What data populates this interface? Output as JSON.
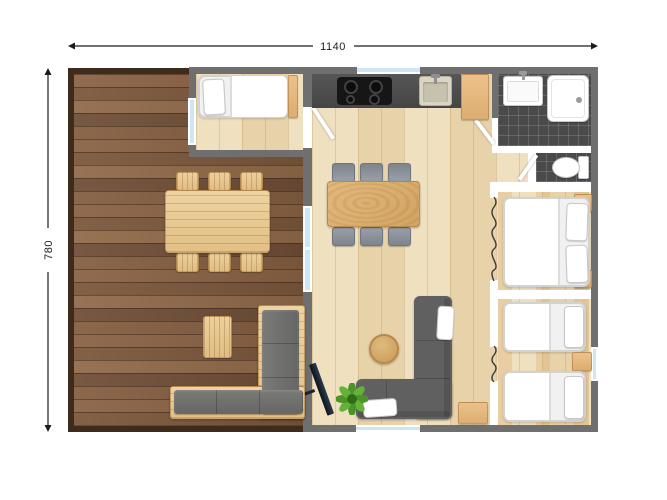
{
  "plan": {
    "width_label": "1140",
    "height_label": "780"
  },
  "colors": {
    "wall": "#6f6f6f",
    "partition": "#ffffff",
    "deck_frame": "#3e2b1c",
    "deck_wood": "#82593c",
    "floor_wood": "#ecdab4",
    "tile": "#4a4a4a",
    "counter": "#4b4b4b",
    "cooktop": "#161616",
    "wood_furniture": "#e3b77f",
    "outdoor_wood": "#e9c992",
    "sofa_gray": "#606060",
    "chair_gray": "#8f959e",
    "cushion_gray": "#6f6f6d",
    "bed_white": "#f1f1f1",
    "window_glass": "#cde6f5",
    "plant_green": "#55a62f",
    "tv_dark": "#16222e",
    "dim_color": "#1c1c1c"
  },
  "legend": {
    "rooms": [
      "deck",
      "small-bedroom",
      "kitchen",
      "living-dining",
      "hallway",
      "bathroom",
      "wc",
      "double-bedroom",
      "twin-bedroom"
    ],
    "furniture": [
      "outdoor-dining-table",
      "outdoor-chairs",
      "outdoor-corner-sofa",
      "outdoor-side-table",
      "single-bed",
      "double-bed",
      "twin-beds",
      "dining-table",
      "dining-chairs",
      "corner-sofa",
      "coffee-table",
      "tv",
      "plant",
      "kitchen-counter",
      "cooktop",
      "kitchen-sink",
      "bathroom-sink",
      "shower",
      "toilet",
      "nightstands",
      "cabinets",
      "curtain-openings",
      "doors",
      "windows"
    ]
  }
}
